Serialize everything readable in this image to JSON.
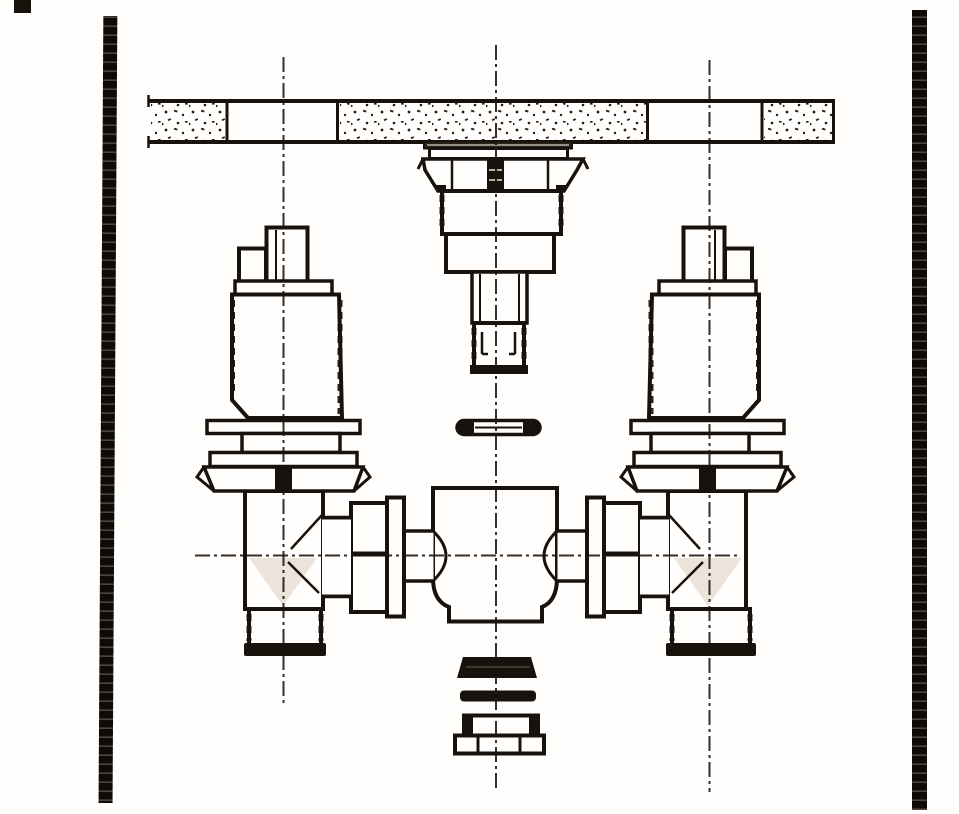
{
  "document": {
    "kind": "scanned engineering line drawing",
    "subject": "Cross-section installation view of a concealed two-valve mixing faucet mounted through a deck/wall section",
    "visible_text": ""
  },
  "colors": {
    "ink": "#18120d",
    "paper": "#fffefc",
    "shade": "#ece4db",
    "stipple": "#241b13",
    "rib": "#0e0a07",
    "ribgap": "#4e443a",
    "ridge": "#4e443a"
  },
  "components": {
    "binding_edge_left": "perforated-binding-strip",
    "binding_edge_right": "perforated-binding-strip",
    "deck_section": "stippled-masonry-deck-cross-section",
    "spout_shank": "center-spout-shank-with-flange-threads-and-gasket",
    "left_valve": "valve-cartridge-with-stem-flanges-and-locknut",
    "right_valve": "valve-cartridge-with-stem-flanges-and-locknut",
    "left_tee": "supply-tee-with-threaded-inlet",
    "right_tee": "supply-tee-with-threaded-inlet",
    "unions": "union-couplings-to-mixing-body",
    "mixing_body": "central-mixing-body-with-valve-seats",
    "bottom_stack": "gaskets-and-cap-nut",
    "centerlines": "dash-dot-centerlines"
  }
}
